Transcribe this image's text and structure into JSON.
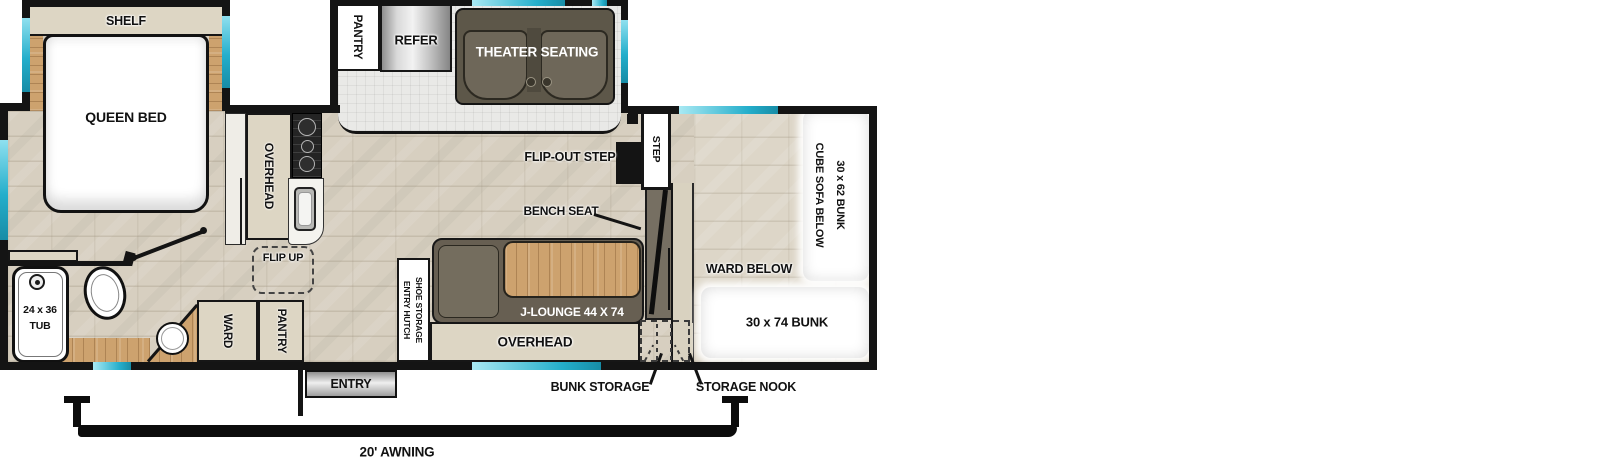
{
  "colors": {
    "wall": "#141414",
    "window": "#24aecb",
    "floor": "#d7cfc0",
    "floor_bunk": "#ddd6c8",
    "slide_floor": "#e9e9e7",
    "cabinet": "#ddd6c4",
    "wood": "#cda26e",
    "sofa": "#5d5749",
    "lounge": "#675f52"
  },
  "bedroom": {
    "shelf": "SHELF",
    "queen_bed": "QUEEN BED"
  },
  "slide_out": {
    "pantry": "PANTRY",
    "refer": "REFER",
    "theater_seating": "THEATER SEATING"
  },
  "kitchen": {
    "overhead": "OVERHEAD",
    "flip_up": "FLIP UP"
  },
  "bathroom": {
    "tub_size": "24 x 36",
    "tub": "TUB",
    "ward": "WARD",
    "pantry": "PANTRY"
  },
  "living": {
    "entry_hutch": "ENTRY HUTCH",
    "shoe_storage": "SHOE STORAGE",
    "j_lounge": "J-LOUNGE 44 X 74",
    "bench_seat": "BENCH SEAT",
    "overhead": "OVERHEAD",
    "flip_out_step": "FLIP-OUT STEP",
    "step": "STEP"
  },
  "bunk_area": {
    "bunk_upper": "30 x 62 BUNK",
    "cube_sofa_below": "CUBE SOFA BELOW",
    "ward_below": "WARD BELOW",
    "bunk_lower": "30 x 74 BUNK",
    "bunk_storage": "BUNK STORAGE",
    "storage_nook": "STORAGE NOOK"
  },
  "exterior": {
    "entry": "ENTRY",
    "awning": "20' AWNING"
  }
}
